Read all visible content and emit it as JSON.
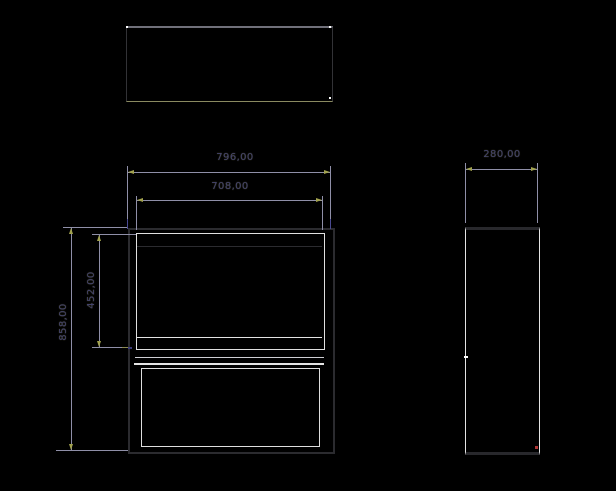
{
  "drawing": {
    "dimensions": {
      "outer_width": "796,00",
      "inner_width": "708,00",
      "depth": "280,00",
      "total_height": "858,00",
      "opening_height": "452,00"
    },
    "colors": {
      "background": "#000000",
      "object_line_dark": "#2b2b2f",
      "object_line_light": "#e4e4e4",
      "top_view_bottom_edge": "#8a8a60",
      "dimension_line": "#8f8fa8",
      "dimension_text": "#43436e",
      "arrowhead": "#a2a24e",
      "extension_tip": "#4a4a92",
      "corner_marker_red": "#b03434"
    }
  }
}
